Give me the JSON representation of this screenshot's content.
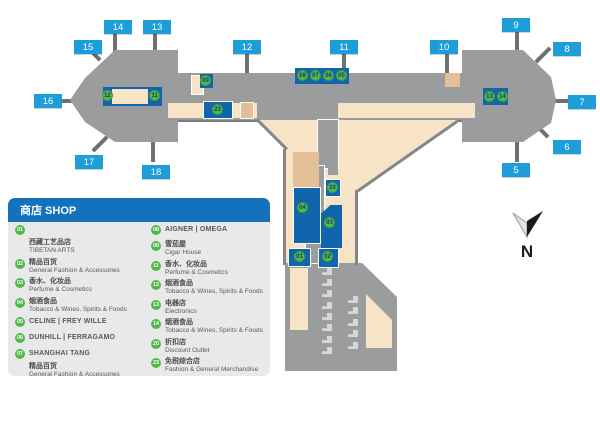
{
  "legend": {
    "title": "商店 SHOP",
    "left": [
      {
        "num": "01",
        "zh": "西藏工艺品店",
        "en": "TIBETAN ARTS"
      },
      {
        "num": "02",
        "zh": "精品百货",
        "en": "General Fashion & Accessories"
      },
      {
        "num": "03",
        "zh": "香水、化妆品",
        "en": "Perfume & Cosmetics"
      },
      {
        "num": "04",
        "zh": "烟酒食品",
        "en": "Tobacco & Wines, Spirits & Foods"
      },
      {
        "num": "05",
        "name": "CELINE | FREY WILLE"
      },
      {
        "num": "06",
        "name": "DUNHILL | FERRAGAMO"
      },
      {
        "num": "07",
        "name": "SHANGHAI TANG",
        "zh2": "精品百货",
        "en2": "General Fashion & Accessories"
      }
    ],
    "right": [
      {
        "num": "08",
        "name": "AIGNER | OMEGA"
      },
      {
        "num": "09",
        "zh": "雪茄屋",
        "en": "Cigar House"
      },
      {
        "num": "11",
        "zh": "香水、化妆品",
        "en": "Perfume & Cosmetics"
      },
      {
        "num": "12",
        "zh": "烟酒食品",
        "en": "Tobacco & Wines, Spirits & Foods"
      },
      {
        "num": "13",
        "zh": "电器店",
        "en": "Electronics"
      },
      {
        "num": "14",
        "zh": "烟酒食品",
        "en": "Tobacco & Wines, Spirits & Foods"
      },
      {
        "num": "20",
        "zh": "折扣店",
        "en": "Discount Outlet"
      },
      {
        "num": "23",
        "zh": "免税综合店",
        "en": "Fashion & General Merchandise"
      }
    ]
  },
  "gates": {
    "g5": "5",
    "g6": "6",
    "g7": "7",
    "g8": "8",
    "g9": "9",
    "g10": "10",
    "g11": "11",
    "g12": "12",
    "g13": "13",
    "g14": "14",
    "g15": "15",
    "g16": "16",
    "g17": "17",
    "g18": "18"
  },
  "markers": {
    "m01": "01",
    "m02": "02",
    "m03": "03",
    "m04": "04",
    "m05": "05",
    "m06": "06",
    "m07": "07",
    "m08": "08",
    "m09": "09",
    "m11": "11",
    "m12": "12",
    "m13": "13",
    "m14": "14",
    "m20": "20",
    "m23": "23"
  },
  "compass": {
    "label": "N"
  },
  "colors": {
    "gate_blue": "#1d9ed9",
    "shop_blue": "#1165ad",
    "legend_blue": "#1472bd",
    "marker_green": "#52b848",
    "terminal_gray": "#9b9c9e",
    "bridge_gray": "#6f7072",
    "floor_beige": "#f7e3c5",
    "floor_tan": "#e3bf97",
    "legend_bg": "#e9e9ea",
    "text_gray": "#58595b"
  }
}
